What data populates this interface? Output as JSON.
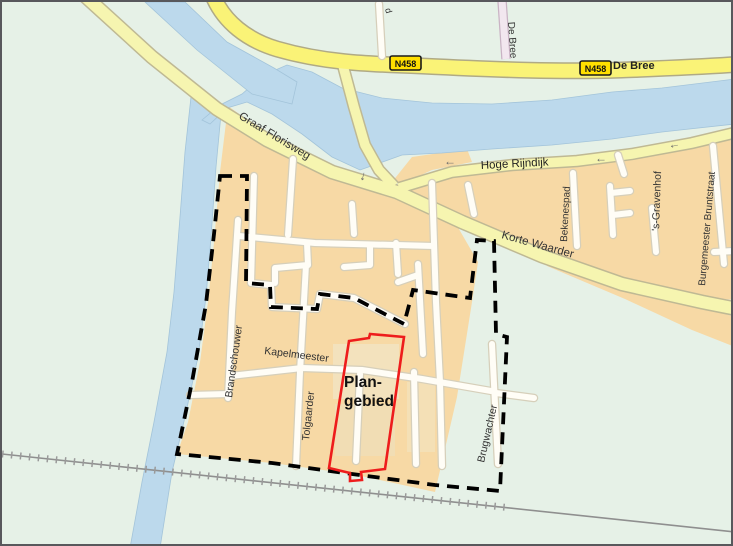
{
  "map": {
    "figure_name": "plangebied-locatiekaart",
    "streets": {
      "graaf_florisweg": "Graaf Florisweg",
      "hoge_rijndijk": "Hoge Rijndijk",
      "korte_waarder": "Korte Waarder",
      "de_bree_sign": "De Bree",
      "de_bree_road": "De Bree",
      "bekenespad": "Bekenespad",
      "s_gravenhof": "'s-Gravenhof",
      "burgemeester_bruntstraat": "Burgemeester Bruntstraat",
      "brandschouwer": "Brandschouwer",
      "kapelmeester": "Kapelmeester",
      "tolgaarder": "Tolgaarder",
      "brugwachter": "Brugwachter",
      "edge_cutoff_label": "d"
    },
    "badges": {
      "n458": "N458"
    },
    "plan_area": {
      "line1": "Plan-",
      "line2": "gebied"
    },
    "symbols": {
      "arrow_left": "←",
      "arrow_down": "↓"
    },
    "colors": {
      "background_green": "#e6f1e7",
      "water_blue": "#bcd9ec",
      "urban_area_orange": "#f7d9a5",
      "main_road_yellow": "#faf377",
      "secondary_road_yellow": "#f6f5b0",
      "local_road_white": "#fffdf6",
      "n458_badge_yellow": "#ffdf00",
      "plan_boundary_dash": "#000000",
      "plan_area_outline_red": "#ee1c1c",
      "railway_gray": "#8f8f8f",
      "street_label_text": "#333333"
    }
  }
}
